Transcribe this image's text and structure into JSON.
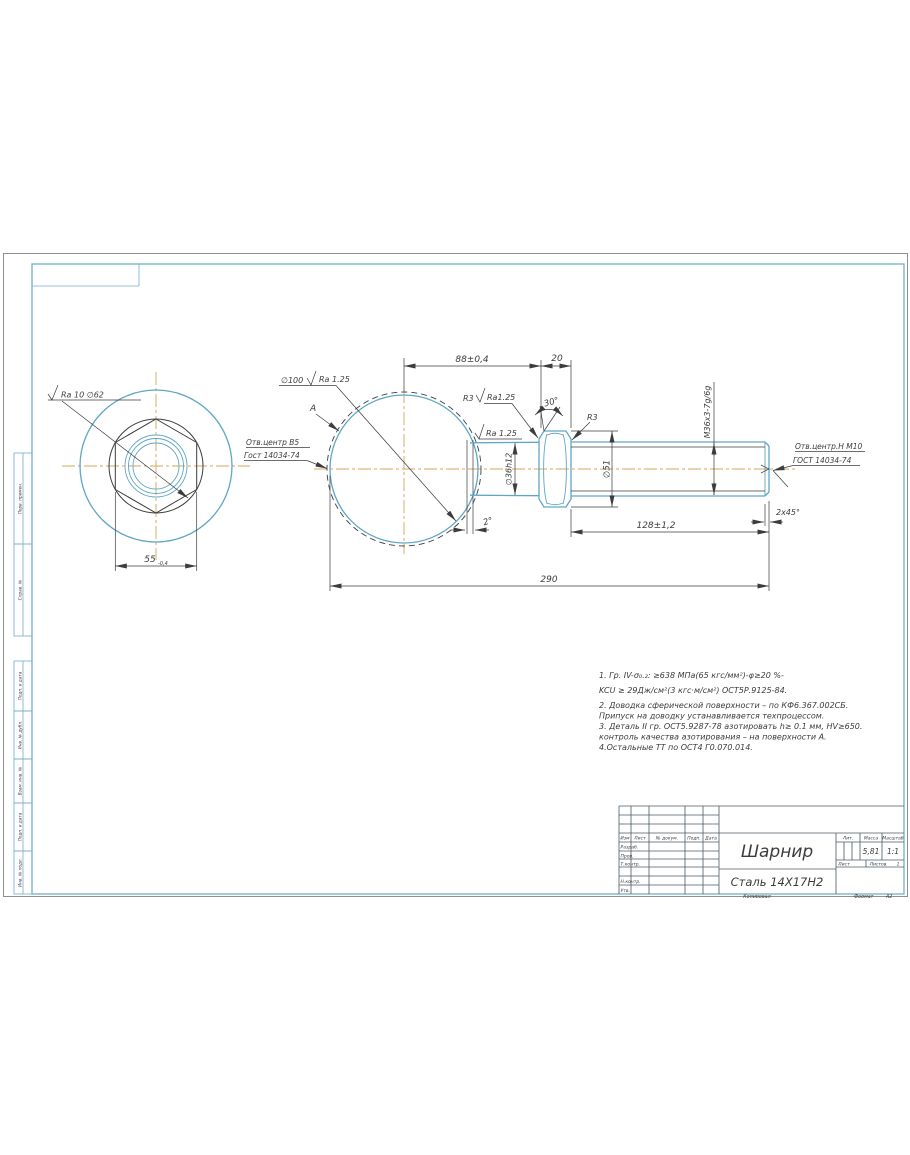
{
  "frame": {
    "left_labels": [
      "Перв. примен.",
      "Справ. №",
      "Подп. и дата",
      "Инв. № дубл.",
      "Взам. инв. №",
      "Подп. и дата",
      "Инв. № подл."
    ]
  },
  "views": {
    "left_view": {
      "surface_label": "Ra 10 ∅62",
      "width_dim": "55",
      "width_tol": "-0,4"
    },
    "main_view": {
      "dim_88": "88±0,4",
      "dim_20": "20",
      "dim_290": "290",
      "dim_128": "128±1,2",
      "dia_sphere": "∅100",
      "sphere_ra": "Ra 1.25",
      "surface_a": "A",
      "center_hole_left_1": "Отв.центр В5",
      "center_hole_left_2": "Гост 14034-74",
      "fillet_label": "R3",
      "fillet_ra": "Ra1.25",
      "neck_ra": "Ra 1.25",
      "angle_30": "30°",
      "fillet_r3_right": "R3",
      "dia_neck": "∅36h12",
      "dia_51": "∅51",
      "thread": "М36х3-7g/6g",
      "angle_2": "2°",
      "chamfer": "2х45°",
      "center_hole_right_1": "Отв.центр.Н М10",
      "center_hole_right_2": "ГОСТ 14034-74"
    }
  },
  "notes": {
    "lines": [
      "1. Гр. IV-σ₀.₂: ≥638 МПа(65 кгс/мм²)-φ≥20 %-",
      "KCU ≥ 29Дж/см²(3 кгс·м/см²) ОСТ5Р.9125-84.",
      "2. Доводка сферической поверхности – по КФ6.367.002СБ.",
      "Припуск на доводку устанавливается техпроцессом.",
      "3. Деталь II гр. ОСТ5.9287-78 азотировать h≥ 0.1 мм, HV≥650.",
      "контроль качества азотирования – на поверхности А.",
      "4.Остальные ТТ по ОСТ4 Г0.070.014."
    ]
  },
  "title_block": {
    "header_cols": [
      "Изм",
      "Лист",
      "№ докум.",
      "Подп.",
      "Дата"
    ],
    "rows": [
      "Разраб.",
      "Пров.",
      "Т.контр.",
      "Н.контр.",
      "Утв."
    ],
    "part_name": "Шарнир",
    "material": "Сталь 14Х17Н2",
    "lit_label": "Лит.",
    "mass_label": "Масса",
    "scale_label": "Масштаб",
    "mass": "5,81",
    "scale": "1:1",
    "sheet_label": "Лист",
    "sheets_label": "Листов",
    "sheets_value": "1",
    "copied": "Копировал",
    "format_label": "Формат",
    "format_value": "А2"
  }
}
